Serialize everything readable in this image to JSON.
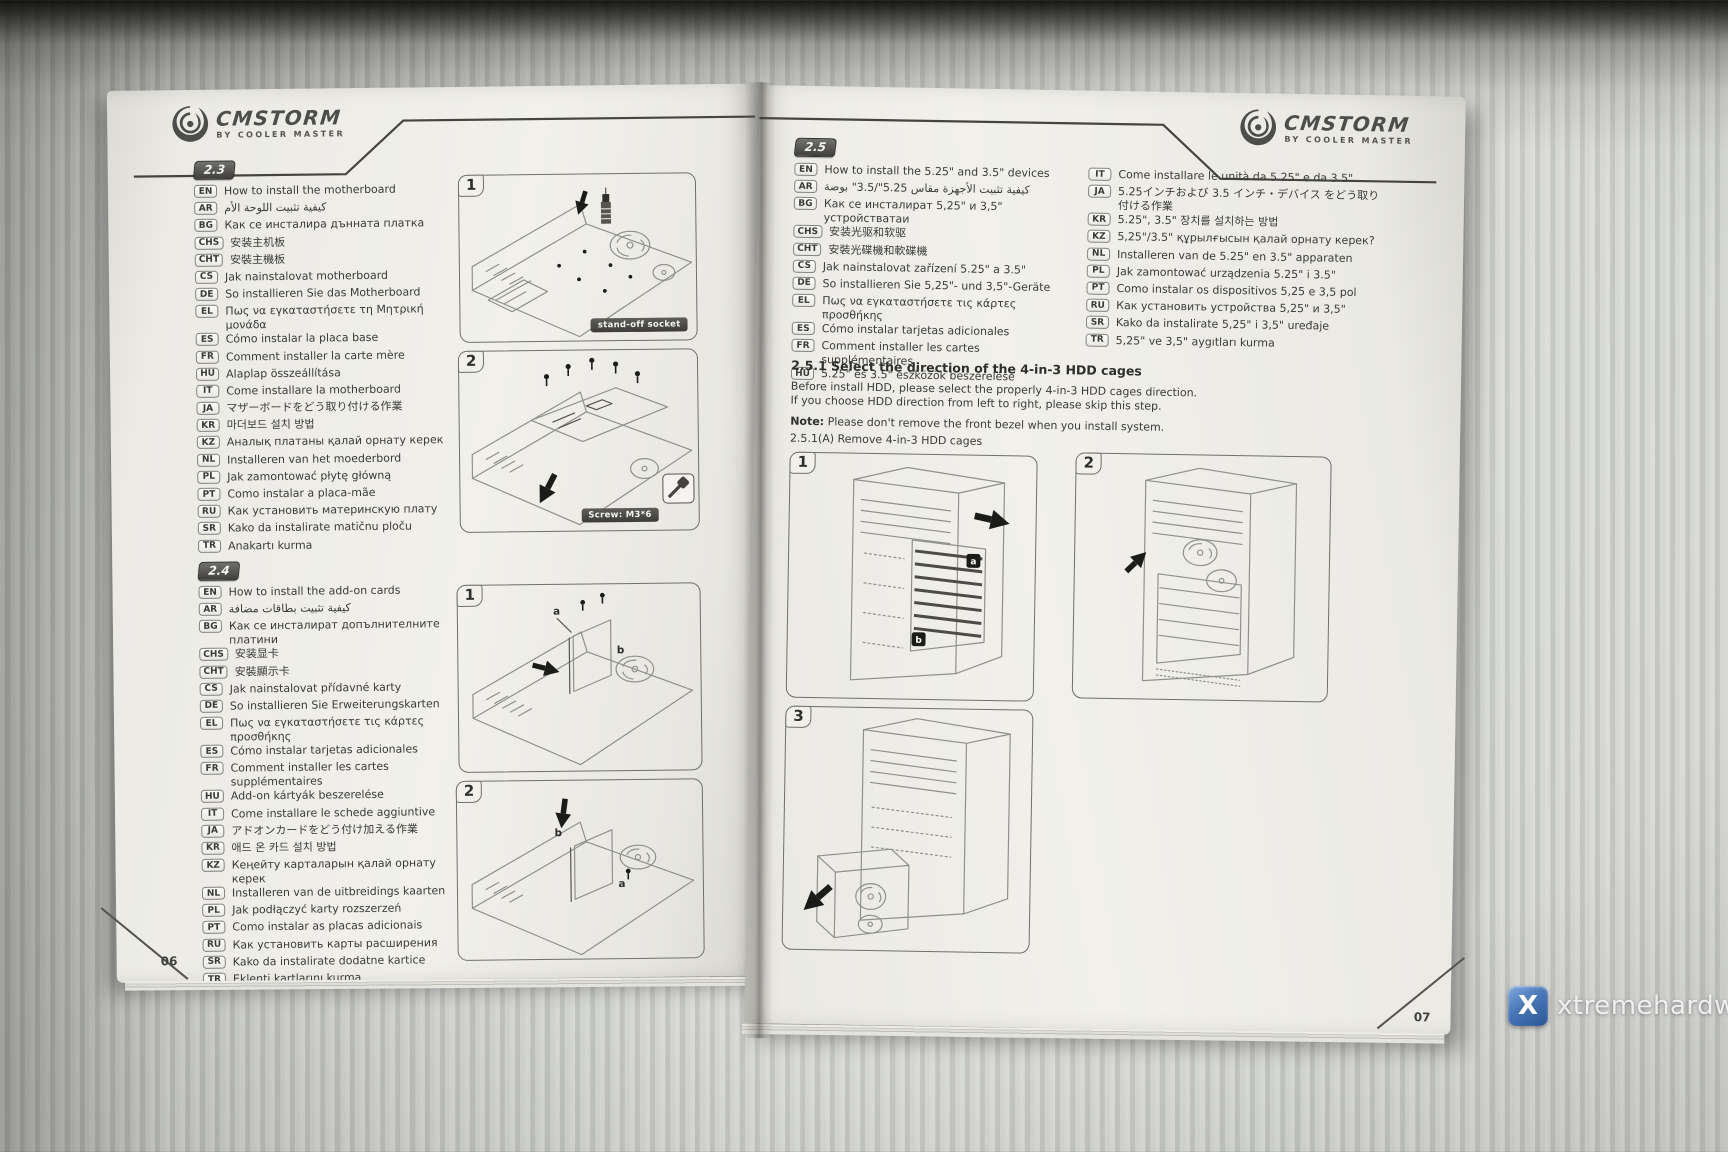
{
  "brand": {
    "name": "CMSTORM",
    "tagline": "BY COOLER MASTER"
  },
  "watermark": {
    "text": "xtremehardware.com",
    "logo_letter": "X",
    "logo_color": "#3e6cb0"
  },
  "left_page": {
    "page_number": "06",
    "section_2_3": {
      "id": "2.3",
      "items": [
        {
          "code": "EN",
          "text": "How to install the motherboard"
        },
        {
          "code": "AR",
          "text": "كيفية تثبيت اللوحة الأم"
        },
        {
          "code": "BG",
          "text": "Как се инсталира дънната платка"
        },
        {
          "code": "CHS",
          "text": "安装主机板"
        },
        {
          "code": "CHT",
          "text": "安裝主機板"
        },
        {
          "code": "CS",
          "text": "Jak nainstalovat motherboard"
        },
        {
          "code": "DE",
          "text": "So installieren Sie das Motherboard"
        },
        {
          "code": "EL",
          "text": "Πως να εγκαταστήσετε τη Μητρική μονάδα"
        },
        {
          "code": "ES",
          "text": "Cómo instalar la placa base"
        },
        {
          "code": "FR",
          "text": "Comment installer la carte mère"
        },
        {
          "code": "HU",
          "text": "Alaplap összeállítása"
        },
        {
          "code": "IT",
          "text": "Come installare la motherboard"
        },
        {
          "code": "JA",
          "text": "マザーボードをどう取り付ける作業"
        },
        {
          "code": "KR",
          "text": "마더보드 설치 방법"
        },
        {
          "code": "KZ",
          "text": "Аналық платаны қалай орнату керек"
        },
        {
          "code": "NL",
          "text": "Installeren van het moederbord"
        },
        {
          "code": "PL",
          "text": "Jak zamontować płytę główną"
        },
        {
          "code": "PT",
          "text": "Como instalar a placa-mãe"
        },
        {
          "code": "RU",
          "text": "Как установить материнскую плату"
        },
        {
          "code": "SR",
          "text": "Kako da instalirate matičnu ploču"
        },
        {
          "code": "TR",
          "text": "Anakartı kurma"
        }
      ]
    },
    "section_2_4": {
      "id": "2.4",
      "items": [
        {
          "code": "EN",
          "text": "How to install the add-on cards"
        },
        {
          "code": "AR",
          "text": "كيفية تثبيت بطاقات مضافة"
        },
        {
          "code": "BG",
          "text": "Как се инсталират допълнителните платини"
        },
        {
          "code": "CHS",
          "text": "安装显卡"
        },
        {
          "code": "CHT",
          "text": "安裝顯示卡"
        },
        {
          "code": "CS",
          "text": "Jak nainstalovat přídavné karty"
        },
        {
          "code": "DE",
          "text": "So installieren Sie Erweiterungskarten"
        },
        {
          "code": "EL",
          "text": "Πως να εγκαταστήσετε τις κάρτες προσθήκης"
        },
        {
          "code": "ES",
          "text": "Cómo instalar tarjetas adicionales"
        },
        {
          "code": "FR",
          "text": "Comment installer les cartes supplémentaires"
        },
        {
          "code": "HU",
          "text": "Add-on kártyák beszerelése"
        },
        {
          "code": "IT",
          "text": "Come installare le schede aggiuntive"
        },
        {
          "code": "JA",
          "text": "アドオンカードをどう付け加える作業"
        },
        {
          "code": "KR",
          "text": "애드 온 카드 설치 방법"
        },
        {
          "code": "KZ",
          "text": "Кеңейту карталарын қалай орнату керек"
        },
        {
          "code": "NL",
          "text": "Installeren van de uitbreidings kaarten"
        },
        {
          "code": "PL",
          "text": "Jak podłączyć karty rozszerzeń"
        },
        {
          "code": "PT",
          "text": "Como instalar as placas adicionais"
        },
        {
          "code": "RU",
          "text": "Как установить карты расширения"
        },
        {
          "code": "SR",
          "text": "Kako da instalirate dodatne kartice"
        },
        {
          "code": "TR",
          "text": "Eklenti kartlarını kurma"
        }
      ]
    },
    "figures": [
      {
        "number": "1",
        "label": "stand-off socket"
      },
      {
        "number": "2",
        "label": "Screw: M3*6"
      },
      {
        "number": "1",
        "letter_a": "a",
        "letter_b": "b"
      },
      {
        "number": "2",
        "letter_a": "a",
        "letter_b": "b"
      }
    ]
  },
  "right_page": {
    "page_number": "07",
    "section_2_5": {
      "id": "2.5",
      "items_left": [
        {
          "code": "EN",
          "text": "How to install the 5.25\" and 3.5\" devices"
        },
        {
          "code": "AR",
          "text": "كيفية تثبيت الأجهزة مقاس 5.25\"/3.5\" بوصة"
        },
        {
          "code": "BG",
          "text": "Как се инсталират 5,25\" и 3,5\" устройстватаи"
        },
        {
          "code": "CHS",
          "text": "安装光驱和软驱"
        },
        {
          "code": "CHT",
          "text": "安裝光碟機和軟碟機"
        },
        {
          "code": "CS",
          "text": "Jak nainstalovat zařízení 5.25\" a 3.5\""
        },
        {
          "code": "DE",
          "text": "So installieren Sie 5,25\"- und 3,5\"-Geräte"
        },
        {
          "code": "EL",
          "text": "Πως να εγκαταστήσετε τις κάρτες προσθήκης"
        },
        {
          "code": "ES",
          "text": "Cómo instalar tarjetas adicionales"
        },
        {
          "code": "FR",
          "text": "Comment installer les cartes supplémentaires"
        },
        {
          "code": "HU",
          "text": "5.25\" és 3.5\" eszközök beszerelése"
        }
      ],
      "items_right": [
        {
          "code": "IT",
          "text": "Come installare le unità da 5.25\" e da 3.5\""
        },
        {
          "code": "JA",
          "text": "5.25インチおよび 3.5 インチ・デバイス をどう取り付ける作業"
        },
        {
          "code": "KR",
          "text": "5.25\", 3.5\" 장치를 설치하는 방법"
        },
        {
          "code": "KZ",
          "text": "5,25\"/3.5\" құрылғысын қалай орнату керек?"
        },
        {
          "code": "NL",
          "text": "Installeren van de 5.25\" en 3.5\" apparaten"
        },
        {
          "code": "PL",
          "text": "Jak zamontować urządzenia 5.25\" i 3.5\""
        },
        {
          "code": "PT",
          "text": "Como instalar os dispositivos 5,25 e 3,5 pol"
        },
        {
          "code": "RU",
          "text": "Как установить устройства 5,25\" и 3,5\""
        },
        {
          "code": "SR",
          "text": "Kako da instalirate 5,25\" i 3,5\" uređaje"
        },
        {
          "code": "TR",
          "text": "5,25\" ve 3,5\" aygıtları kurma"
        }
      ]
    },
    "subsection_2_5_1": {
      "title": "2.5.1 Select the direction of the 4-in-3 HDD cages",
      "body_line_1": "Before install HDD, please select the properly 4-in-3 HDD cages direction.",
      "body_line_2": "If you choose HDD direction from left to right, please skip this step.",
      "note_label": "Note:",
      "note_text": "Please don't remove the front bezel when you install system.",
      "figure_caption": "2.5.1(A) Remove  4-in-3 HDD cages"
    },
    "figures": [
      {
        "number": "1",
        "letter_a": "a",
        "letter_b": "b"
      },
      {
        "number": "2"
      },
      {
        "number": "3"
      }
    ]
  }
}
